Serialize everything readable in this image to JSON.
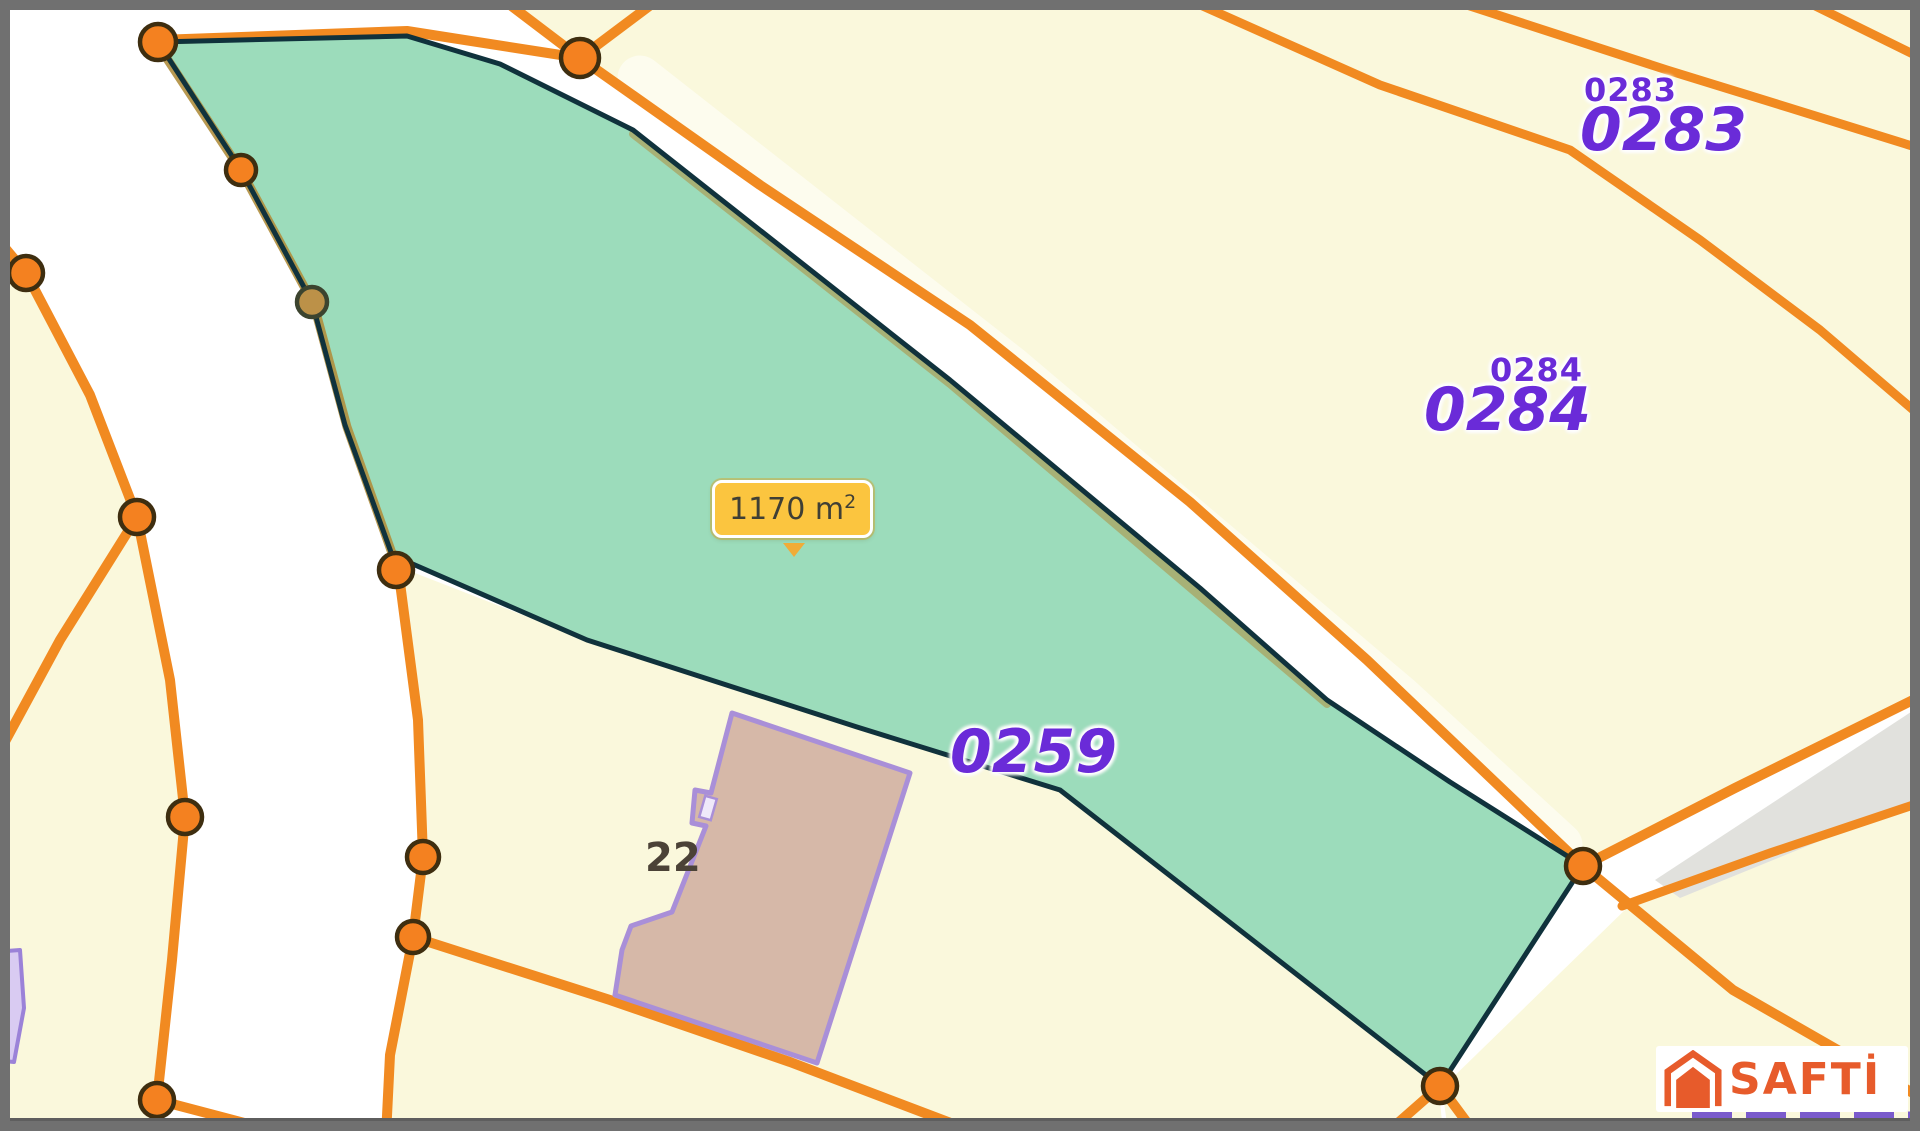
{
  "map": {
    "area_badge": {
      "value": "1170",
      "unit": "m",
      "exponent": "2"
    },
    "parcel_labels": {
      "p0283": {
        "small": "0283",
        "large": "0283"
      },
      "p0284": {
        "small": "0284",
        "large": "0284"
      },
      "p0259": {
        "large": "0259"
      }
    },
    "building_number": "22"
  },
  "watermark": {
    "brand": "SAFTİ"
  },
  "theme": {
    "colors": {
      "road-orange": "#F18A21",
      "marker-orange": "#F48120",
      "marker-ring": "#3E2E10",
      "parcel-yellow": "#FAF8DC",
      "highlight-teal": "rgba(134,212,172,0.82)",
      "outline-navy": "#10323C",
      "olive-edge": "#B08E3E",
      "label-purple": "#6A2BD8",
      "building-fill": "#D6B8A8",
      "building-stroke": "#A98FD8",
      "badge-yellow": "#FBC53F",
      "badge-border": "#FFFFFF",
      "badge-arrow": "#F0AC38",
      "badge-text": "#3F3F35",
      "brand-orange": "#E75B2B",
      "border-gray": "#707070",
      "gray-strip": "#E1E1DD",
      "dash-purple": "#7A5BCC",
      "number-dark": "#4B4237"
    }
  }
}
